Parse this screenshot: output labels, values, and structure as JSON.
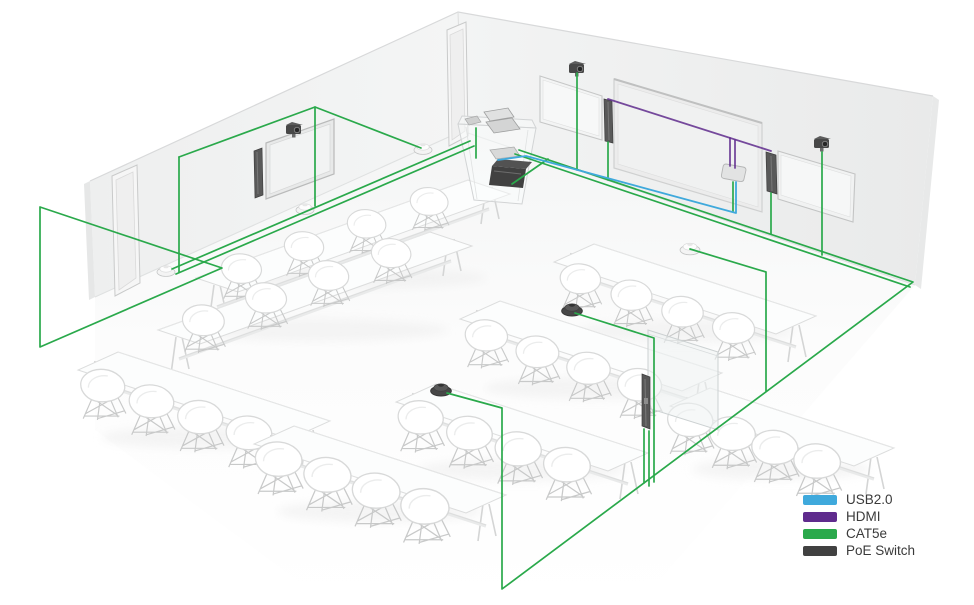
{
  "legend": {
    "items": [
      {
        "label": "USB2.0",
        "color": "#3fa9dc"
      },
      {
        "label": "HDMI",
        "color": "#5f2b8d"
      },
      {
        "label": "CAT5e",
        "color": "#2aa94b"
      },
      {
        "label": "PoE Switch",
        "color": "#414141"
      }
    ]
  },
  "scene": {
    "equipment": {
      "ptz_cameras": 3,
      "wall_displays": 4,
      "sound_bars": 4,
      "ceiling_mics": 3,
      "table_mics": 3,
      "podium": 1,
      "poe_switch": 1,
      "glass_partitions": 1,
      "tables": 8,
      "chairs": 32
    }
  }
}
